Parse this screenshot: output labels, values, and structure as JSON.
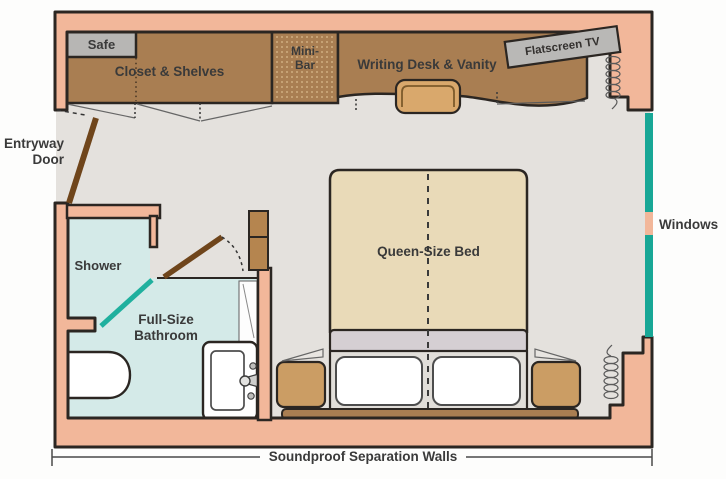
{
  "floorplan": {
    "type": "stateroom-floor-plan",
    "areas": {
      "safe": {
        "label": "Safe"
      },
      "closet": {
        "label": "Closet & Shelves"
      },
      "minibar": {
        "line1": "Mini-",
        "line2": "Bar"
      },
      "desk": {
        "label": "Writing Desk & Vanity"
      },
      "tv": {
        "label": "Flatscreen TV"
      },
      "shower": {
        "label": "Shower"
      },
      "bathroom": {
        "line1": "Full-Size",
        "line2": "Bathroom"
      },
      "bed": {
        "label": "Queen-Size Bed"
      }
    },
    "annotations": {
      "entry": {
        "line1": "Entryway",
        "line2": "Door"
      },
      "windows": {
        "label": "Windows"
      },
      "soundproof": {
        "label": "Soundproof Separation Walls"
      }
    },
    "colors": {
      "wall": "#f2b79a",
      "outline": "#2b2622",
      "floor": "#e4e1dd",
      "wood": "#a97e52",
      "wood_light": "#cb9d64",
      "door_wood": "#6f451b",
      "bed": "#e9dab8",
      "blanket": "#d5cfd3",
      "bathroom_floor": "#d4eae8",
      "window_teal": "#18a796",
      "fixture_gray": "#b7b6b4",
      "label_text": "#3a3a3a"
    }
  }
}
